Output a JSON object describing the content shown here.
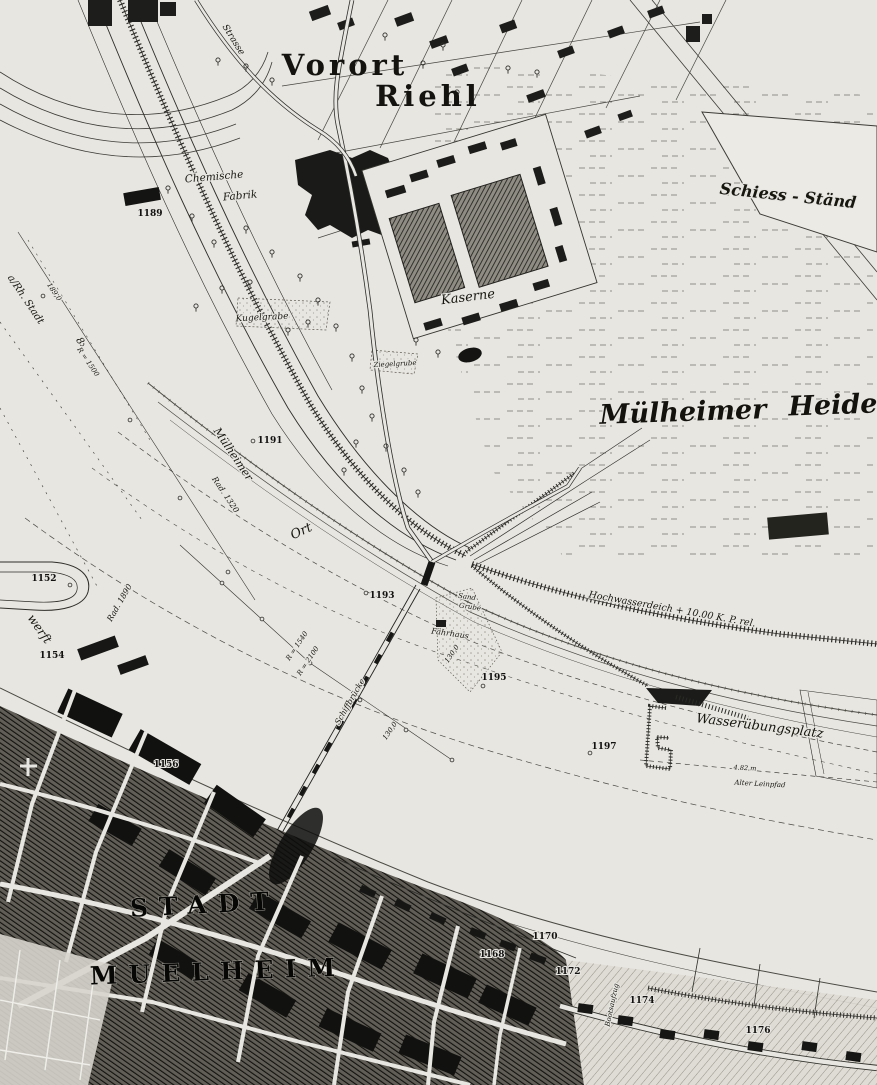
{
  "map": {
    "region_labels": {
      "vorort": "Vorort",
      "riehl": "Riehl",
      "muelheimer_heide_a": "Mülheimer",
      "muelheimer_heide_b": "Heide",
      "schiess_staende": "Schiess - Ständ",
      "kaserne": "Kaserne",
      "chemische": "Chemische",
      "fabrik": "Fabrik",
      "wasseruebungsplatz": "Wasserübungsplatz",
      "hochwasserdeich": "Hochwasserdeich + 10.00 K. P. rel.",
      "schiffbruecke": "Schiffbrücke",
      "faehrhaus": "Fährhaus",
      "sand": "Sand",
      "grube": "Grube",
      "kugelgrabe": "Kugelgrabe",
      "ziegelgrube": "Ziegelgrube",
      "strasse": "Strasse",
      "muelheimer_ufer": "Mülheimer",
      "ort": "Ort",
      "werft": "werft",
      "rh_stadt": "a/Rh. Stadt",
      "alter_leinpfad": "Alter Leinpfad",
      "bootsaufzug": "Bootsaufzug",
      "stadt": "STADT",
      "muelheim": "MUELHEIM"
    },
    "measurements": {
      "rad_1320": "Rad. 1320",
      "rad_1890": "Rad. 1890",
      "r_1540": "R = 1540",
      "r_2100": "R = 2100",
      "r_1500": "R = 1500",
      "km_189": "189,0",
      "len_130a": "130,0",
      "len_130b": "130,0",
      "h_482": "4.82 m",
      "eight": "8"
    },
    "parcel_numbers": {
      "n1152": "1152",
      "n1154": "1154",
      "n1156": "1156",
      "n1168": "1168",
      "n1170": "1170",
      "n1172": "1172",
      "n1174": "1174",
      "n1176": "1176",
      "n1189": "1189",
      "n1191": "1191",
      "n1193": "1193",
      "n1195": "1195",
      "n1197": "1197"
    }
  }
}
